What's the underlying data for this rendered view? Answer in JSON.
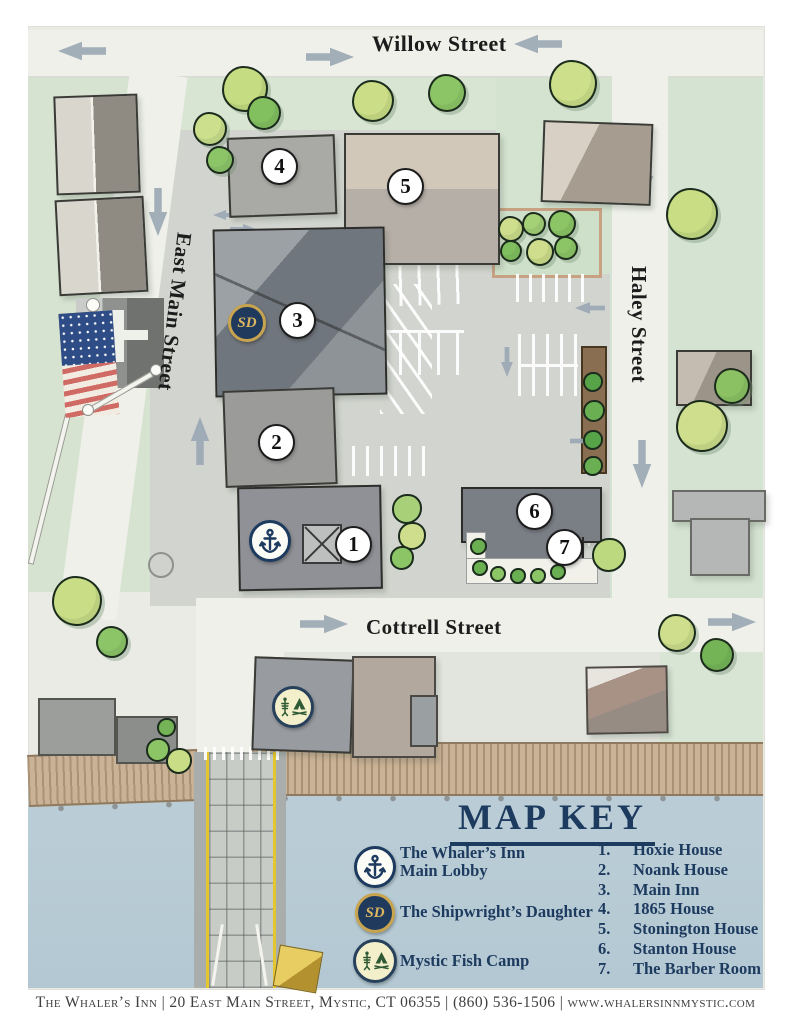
{
  "page": {
    "footer": "The Whaler’s Inn | 20 East Main Street, Mystic, CT 06355 | (860) 536-1506 | www.whalersinnmystic.com"
  },
  "streets": {
    "willow": "Willow Street",
    "east_main": "East Main Street",
    "haley": "Haley Street",
    "cottrell": "Cottrell Street"
  },
  "markers": [
    "1",
    "2",
    "3",
    "4",
    "5",
    "6",
    "7"
  ],
  "icons": {
    "sd_monogram": "SD"
  },
  "map_key": {
    "title": "MAP KEY",
    "legend": [
      {
        "icon": "anchor-icon",
        "line1": "The Whaler’s Inn",
        "line2": "Main Lobby"
      },
      {
        "icon": "sd-monogram-icon",
        "line1": "The Shipwright’s Daughter",
        "line2": ""
      },
      {
        "icon": "fish-camp-icon",
        "line1": "Mystic Fish Camp",
        "line2": ""
      }
    ],
    "numbered": [
      {
        "num": "1.",
        "label": "Hoxie House"
      },
      {
        "num": "2.",
        "label": "Noank House"
      },
      {
        "num": "3.",
        "label": "Main Inn"
      },
      {
        "num": "4.",
        "label": "1865 House"
      },
      {
        "num": "5.",
        "label": "Stonington House"
      },
      {
        "num": "6.",
        "label": "Stanton House"
      },
      {
        "num": "7.",
        "label": "The Barber Room"
      }
    ]
  },
  "colors": {
    "navy": "#1d3a5f",
    "gold": "#c9a44e",
    "water": "#b7cbd5",
    "road": "#eef0e9",
    "green": "#d6e3d1",
    "boardwalk": "#c9b295",
    "arrow_gray": "#99a6b2"
  }
}
